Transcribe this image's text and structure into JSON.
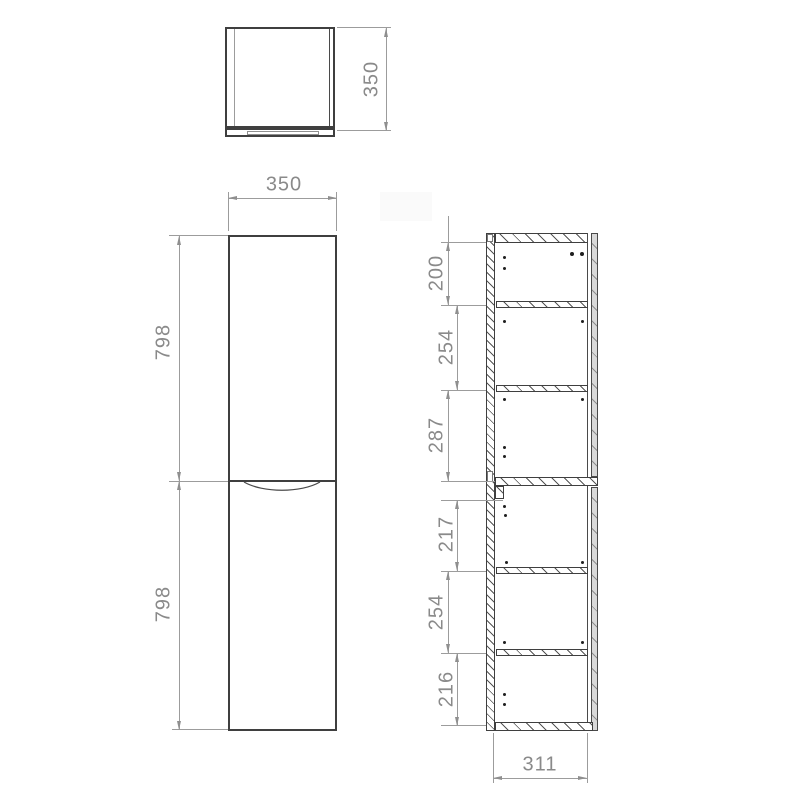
{
  "views": {
    "top_view": {
      "depth_dim": "350"
    },
    "front_view": {
      "width_dim": "350",
      "upper_door_dim": "798",
      "lower_door_dim": "798"
    },
    "section_view": {
      "shelf_dims": [
        "200",
        "254",
        "287",
        "217",
        "254",
        "216"
      ],
      "internal_width_dim": "311"
    }
  },
  "colors": {
    "outline": "#3f3f3f",
    "dimension_line": "#9c9c9c",
    "dimension_text": "#8a8a8a",
    "background": "#ffffff"
  }
}
